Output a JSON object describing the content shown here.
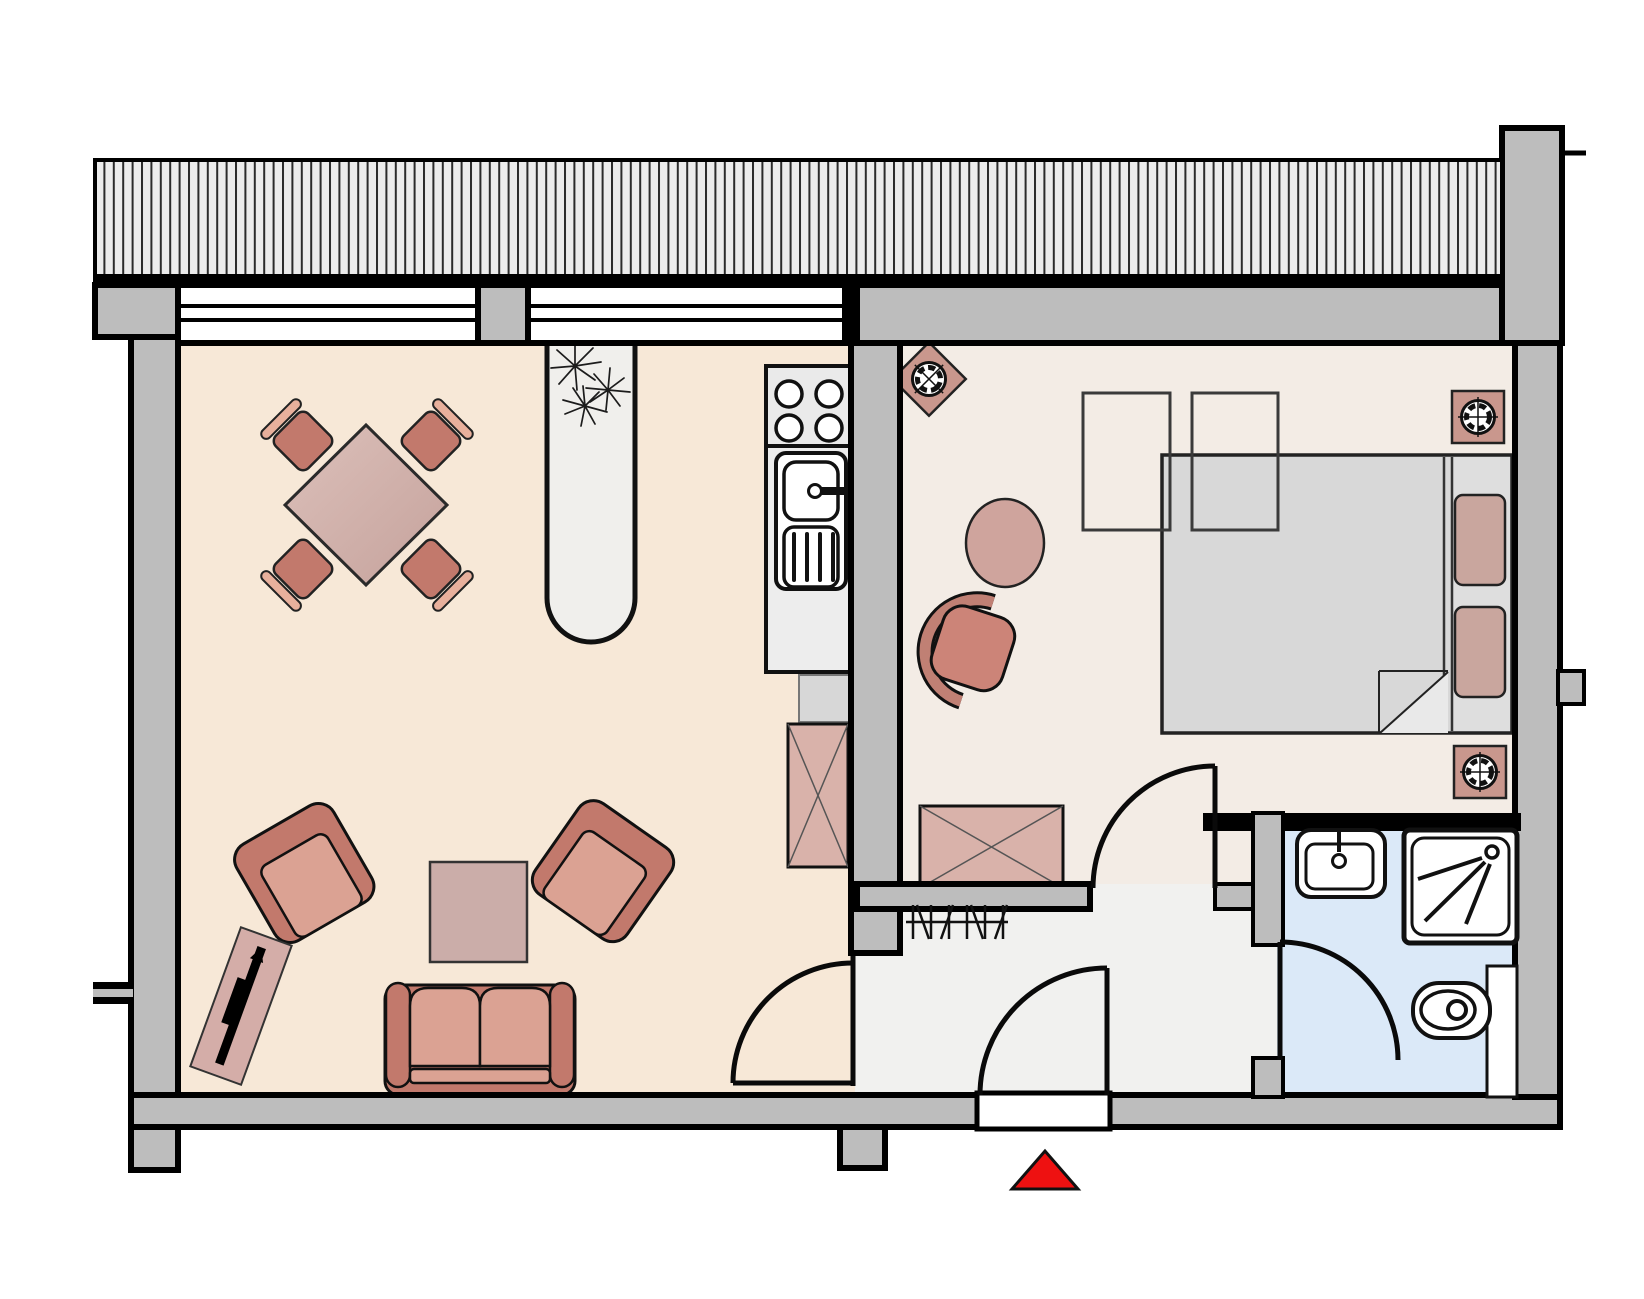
{
  "plan": {
    "kind": "apartment-floor-plan",
    "entrance_marker": "red-triangle",
    "rooms": [
      {
        "id": "living-room",
        "floor": "beige",
        "furniture": [
          "dining-table-diamond",
          "dining-chair",
          "dining-chair",
          "dining-chair",
          "dining-chair",
          "plant-alcove",
          "armchair",
          "armchair",
          "coffee-table",
          "sofa-2-seat",
          "tv-board"
        ]
      },
      {
        "id": "kitchen-strip",
        "floor": "beige",
        "furniture": [
          "stove-4-burners",
          "sink-with-drainboard",
          "counter",
          "appliance-square",
          "cabinet-x-symbol"
        ]
      },
      {
        "id": "bedroom",
        "floor": "pale",
        "furniture": [
          "double-bed-with-pillows",
          "fold-back-duvet",
          "wardrobe-outline",
          "wardrobe-outline",
          "round-side-table",
          "desk-chair",
          "dresser-x-symbol",
          "speaker-diamond",
          "speaker-square",
          "speaker-square"
        ]
      },
      {
        "id": "hallway",
        "floor": "light-gray",
        "furniture": [
          "coat-hooks"
        ]
      },
      {
        "id": "bathroom",
        "floor": "light-blue",
        "furniture": [
          "wash-basin",
          "shower",
          "toilet-with-cistern"
        ]
      }
    ],
    "openings": [
      "balcony-hatched-strip",
      "window-band-left",
      "window-band-right",
      "door-living-to-hall",
      "door-bedroom-to-hall",
      "door-bathroom",
      "entrance-door-with-threshold"
    ]
  },
  "colors": {
    "wall": "#bdbdbd",
    "floor-living": "#f7e8d7",
    "floor-bedroom": "#f3ece5",
    "floor-hall": "#f1f1ef",
    "floor-bath": "#dbe9f8",
    "hatch-bg": "#ececec",
    "rose-dark": "#c2796c",
    "rose-mid": "#cc8478",
    "rose-light": "#dba293",
    "rose-pale": "#e8b09c",
    "mauve": "#cbada9",
    "xbox": "#d9b2aa",
    "pillow": "#c9a69e",
    "speaker": "#c9978d",
    "bed-gray": "#d8d8d8",
    "bed-light": "#e9e9e9",
    "counter": "#ededed",
    "accent-red": "#ee1111"
  }
}
